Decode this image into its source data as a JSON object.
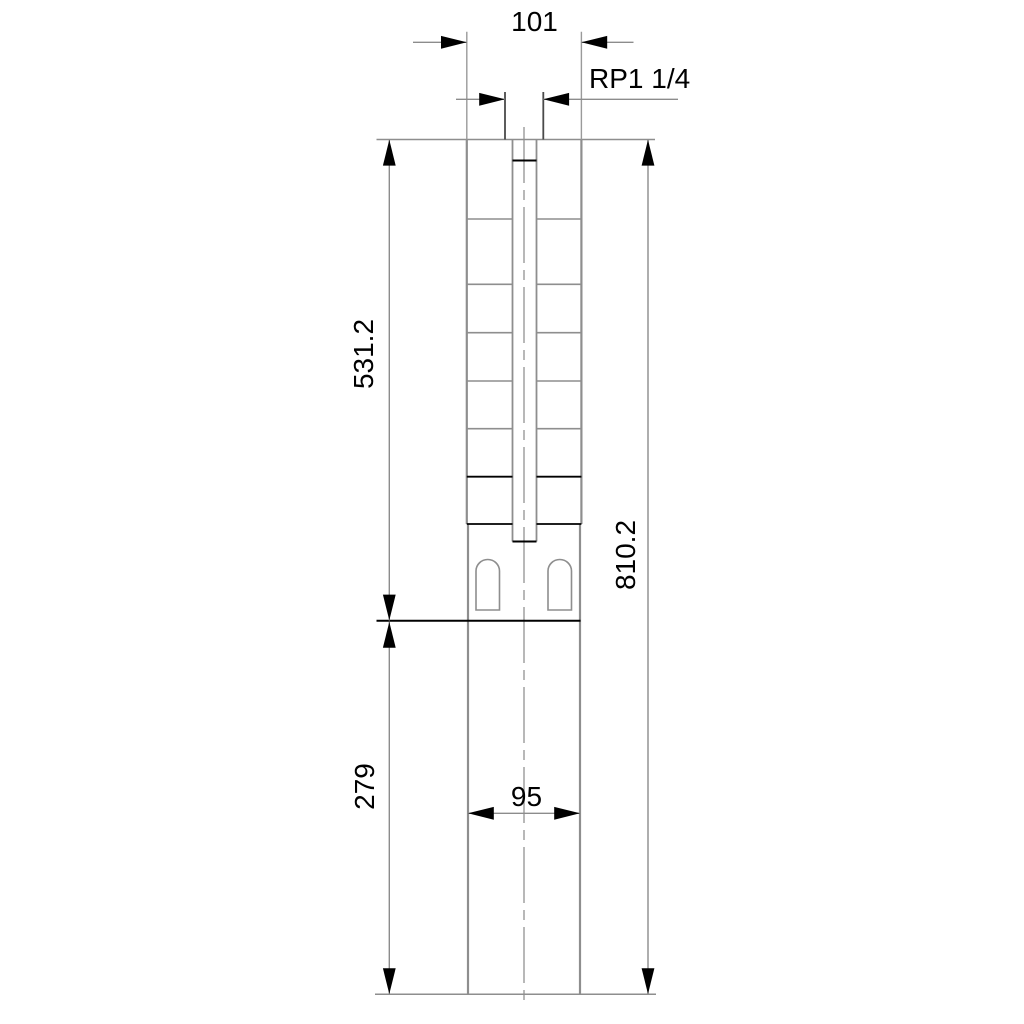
{
  "drawing": {
    "kind": "technical-dimension-outline",
    "subject": "submersible borehole pump with motor, front view",
    "units_shown": "mm",
    "labels": {
      "top_width": "101",
      "thread": "RP1 1/4",
      "pump_length": "531.2",
      "total_length": "810.2",
      "motor_length": "279",
      "motor_width": "95"
    },
    "colors": {
      "background": "#ffffff",
      "outline_gray": "#8e8e8e",
      "accent_black": "#000000",
      "dimension_gray": "#8c8c8c",
      "extension_dark": "#4a4a4a",
      "text": "#000000"
    }
  }
}
